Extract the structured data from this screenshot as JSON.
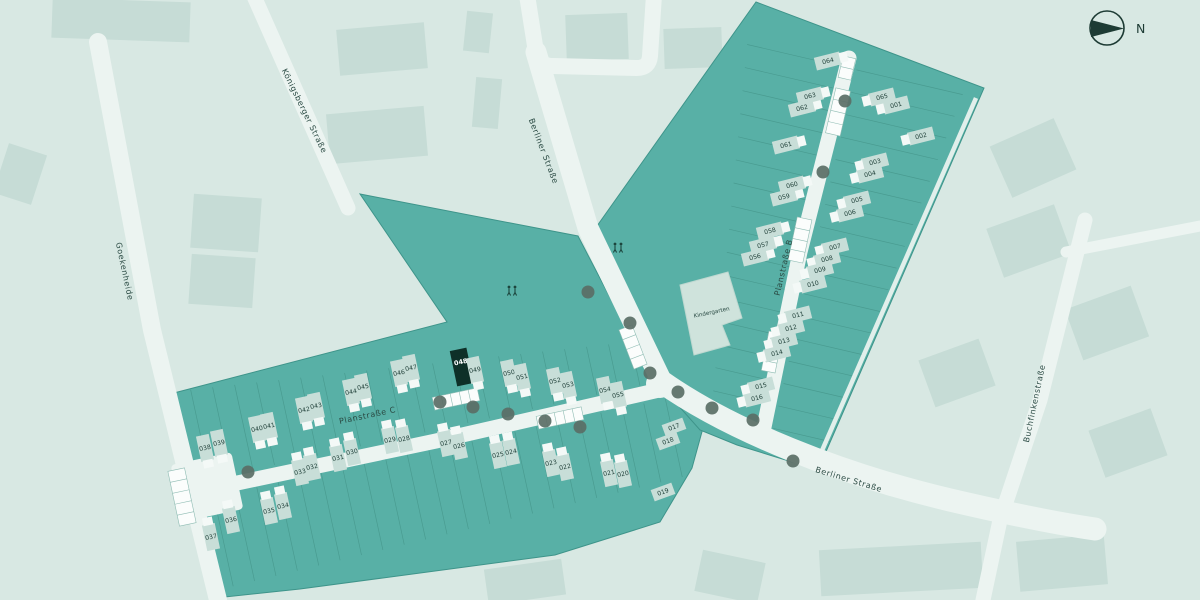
{
  "map": {
    "colors": {
      "bg": "#d8e8e3",
      "bgBuilding": "#c6dcd6",
      "area": "#58b0a6",
      "areaEdge": "#3e948a",
      "stripLine": "#47988d",
      "road": "#ecf4f1",
      "sidewalk": "#e9f2ee",
      "house": "#c8ded8",
      "houseWing": "#f4f9f7",
      "highlight": "#0e3028",
      "plotLabel": "#1e3e37",
      "plotLabelHl": "#ffffff",
      "streetLabel": "#2a4a43",
      "tree": "#5a6e66",
      "compass": "#1d3b34",
      "kindergartenFill": "#cfe3dc",
      "parkingStroke": "#8fbcb3"
    },
    "compass": {
      "label": "N"
    },
    "kindergarten": {
      "label": "Kindergarten",
      "x": 712,
      "y": 314,
      "rot": -12
    },
    "highlighted_plot": "048",
    "streets": [
      {
        "name": "Goekenheide",
        "x": 122,
        "y": 272,
        "rot": 78
      },
      {
        "name": "Königsberger Straße",
        "x": 302,
        "y": 112,
        "rot": 64
      },
      {
        "name": "Berliner Straße",
        "x": 541,
        "y": 152,
        "rot": 69
      },
      {
        "name": "Berliner Straße",
        "x": 848,
        "y": 482,
        "rot": 17
      },
      {
        "name": "Buchfinkenstraße",
        "x": 1037,
        "y": 404,
        "rot": -78
      },
      {
        "name": "Planstraße B",
        "x": 786,
        "y": 268,
        "rot": -77
      },
      {
        "name": "Planstraße C",
        "x": 368,
        "y": 418,
        "rot": -12
      }
    ],
    "plots": [
      {
        "n": "001",
        "x": 896,
        "y": 105,
        "s": "BE"
      },
      {
        "n": "002",
        "x": 921,
        "y": 136,
        "s": "BE"
      },
      {
        "n": "003",
        "x": 875,
        "y": 162,
        "s": "BE"
      },
      {
        "n": "004",
        "x": 870,
        "y": 174,
        "s": "BE"
      },
      {
        "n": "005",
        "x": 857,
        "y": 200,
        "s": "BE"
      },
      {
        "n": "006",
        "x": 850,
        "y": 213,
        "s": "BE"
      },
      {
        "n": "007",
        "x": 835,
        "y": 247,
        "s": "BE"
      },
      {
        "n": "008",
        "x": 827,
        "y": 259,
        "s": "BE"
      },
      {
        "n": "009",
        "x": 820,
        "y": 270,
        "s": "BE"
      },
      {
        "n": "010",
        "x": 813,
        "y": 284,
        "s": "BE"
      },
      {
        "n": "011",
        "x": 798,
        "y": 315,
        "s": "BE"
      },
      {
        "n": "012",
        "x": 791,
        "y": 328,
        "s": "BE"
      },
      {
        "n": "013",
        "x": 784,
        "y": 341,
        "s": "BE"
      },
      {
        "n": "014",
        "x": 777,
        "y": 353,
        "s": "BE"
      },
      {
        "n": "015",
        "x": 761,
        "y": 386,
        "s": "BE"
      },
      {
        "n": "016",
        "x": 757,
        "y": 398,
        "s": "BE"
      },
      {
        "n": "017",
        "x": 674,
        "y": 427,
        "s": "X"
      },
      {
        "n": "018",
        "x": 668,
        "y": 441,
        "s": "X"
      },
      {
        "n": "019",
        "x": 663,
        "y": 492,
        "s": "X"
      },
      {
        "n": "020",
        "x": 623,
        "y": 474,
        "s": "CS"
      },
      {
        "n": "021",
        "x": 609,
        "y": 473,
        "s": "CS"
      },
      {
        "n": "022",
        "x": 565,
        "y": 467,
        "s": "CS"
      },
      {
        "n": "023",
        "x": 551,
        "y": 463,
        "s": "CS"
      },
      {
        "n": "024",
        "x": 511,
        "y": 452,
        "s": "CS"
      },
      {
        "n": "025",
        "x": 498,
        "y": 455,
        "s": "CS"
      },
      {
        "n": "026",
        "x": 459,
        "y": 446,
        "s": "CS"
      },
      {
        "n": "027",
        "x": 446,
        "y": 443,
        "s": "CS"
      },
      {
        "n": "028",
        "x": 404,
        "y": 439,
        "s": "CS"
      },
      {
        "n": "029",
        "x": 390,
        "y": 440,
        "s": "CS"
      },
      {
        "n": "030",
        "x": 352,
        "y": 452,
        "s": "CS"
      },
      {
        "n": "031",
        "x": 338,
        "y": 458,
        "s": "CS"
      },
      {
        "n": "032",
        "x": 312,
        "y": 467,
        "s": "CS"
      },
      {
        "n": "033",
        "x": 300,
        "y": 472,
        "s": "CS"
      },
      {
        "n": "034",
        "x": 283,
        "y": 506,
        "s": "CS"
      },
      {
        "n": "035",
        "x": 269,
        "y": 511,
        "s": "CS"
      },
      {
        "n": "036",
        "x": 231,
        "y": 520,
        "s": "CS"
      },
      {
        "n": "037",
        "x": 211,
        "y": 537,
        "s": "CS"
      },
      {
        "n": "038",
        "x": 205,
        "y": 448,
        "s": "CN"
      },
      {
        "n": "039",
        "x": 219,
        "y": 443,
        "s": "CN"
      },
      {
        "n": "040",
        "x": 257,
        "y": 429,
        "s": "CN"
      },
      {
        "n": "041",
        "x": 269,
        "y": 426,
        "s": "CN"
      },
      {
        "n": "042",
        "x": 304,
        "y": 410,
        "s": "CN"
      },
      {
        "n": "043",
        "x": 316,
        "y": 406,
        "s": "CN"
      },
      {
        "n": "044",
        "x": 351,
        "y": 392,
        "s": "CN"
      },
      {
        "n": "045",
        "x": 363,
        "y": 387,
        "s": "CN"
      },
      {
        "n": "046",
        "x": 399,
        "y": 373,
        "s": "CN"
      },
      {
        "n": "047",
        "x": 411,
        "y": 368,
        "s": "CN"
      },
      {
        "n": "048",
        "x": 462,
        "y": 368,
        "s": "CN",
        "hl": true
      },
      {
        "n": "049",
        "x": 475,
        "y": 370,
        "s": "CN"
      },
      {
        "n": "050",
        "x": 509,
        "y": 373,
        "s": "CN"
      },
      {
        "n": "051",
        "x": 522,
        "y": 377,
        "s": "CN"
      },
      {
        "n": "052",
        "x": 555,
        "y": 381,
        "s": "CN"
      },
      {
        "n": "053",
        "x": 568,
        "y": 385,
        "s": "CN"
      },
      {
        "n": "054",
        "x": 605,
        "y": 390,
        "s": "CN"
      },
      {
        "n": "055",
        "x": 618,
        "y": 395,
        "s": "CN"
      },
      {
        "n": "056",
        "x": 755,
        "y": 257,
        "s": "BW"
      },
      {
        "n": "057",
        "x": 763,
        "y": 245,
        "s": "BW"
      },
      {
        "n": "058",
        "x": 770,
        "y": 231,
        "s": "BW"
      },
      {
        "n": "059",
        "x": 784,
        "y": 197,
        "s": "BW"
      },
      {
        "n": "060",
        "x": 792,
        "y": 185,
        "s": "BW"
      },
      {
        "n": "061",
        "x": 786,
        "y": 145,
        "s": "BW"
      },
      {
        "n": "062",
        "x": 802,
        "y": 108,
        "s": "BW"
      },
      {
        "n": "063",
        "x": 810,
        "y": 96,
        "s": "BW"
      },
      {
        "n": "064",
        "x": 828,
        "y": 61,
        "s": "BW"
      },
      {
        "n": "065",
        "x": 882,
        "y": 97,
        "s": "BE"
      }
    ],
    "trees": [
      {
        "x": 845,
        "y": 101
      },
      {
        "x": 823,
        "y": 172
      },
      {
        "x": 753,
        "y": 420
      },
      {
        "x": 588,
        "y": 292
      },
      {
        "x": 630,
        "y": 323
      },
      {
        "x": 650,
        "y": 373
      },
      {
        "x": 678,
        "y": 392
      },
      {
        "x": 712,
        "y": 408
      },
      {
        "x": 793,
        "y": 461
      },
      {
        "x": 248,
        "y": 472
      },
      {
        "x": 440,
        "y": 402
      },
      {
        "x": 473,
        "y": 407
      },
      {
        "x": 508,
        "y": 414
      },
      {
        "x": 545,
        "y": 421
      },
      {
        "x": 580,
        "y": 427
      }
    ],
    "playgrounds": [
      {
        "x": 618,
        "y": 248
      },
      {
        "x": 512,
        "y": 291
      }
    ],
    "parking": [
      {
        "x": 847,
        "y": 68,
        "w": 13,
        "h": 22,
        "r": 13,
        "slots": 2
      },
      {
        "x": 838,
        "y": 112,
        "w": 15,
        "h": 46,
        "r": 13,
        "slots": 4
      },
      {
        "x": 800,
        "y": 240,
        "w": 15,
        "h": 44,
        "r": 12,
        "slots": 4
      },
      {
        "x": 772,
        "y": 352,
        "w": 14,
        "h": 40,
        "r": 11,
        "slots": 4
      },
      {
        "x": 633,
        "y": 347,
        "w": 14,
        "h": 42,
        "r": -21,
        "slots": 4
      },
      {
        "x": 456,
        "y": 399,
        "w": 46,
        "h": 13,
        "r": -12,
        "slots": 5
      },
      {
        "x": 560,
        "y": 418,
        "w": 46,
        "h": 13,
        "r": -12,
        "slots": 5
      },
      {
        "x": 182,
        "y": 497,
        "w": 17,
        "h": 56,
        "r": -12,
        "slots": 5
      }
    ]
  }
}
